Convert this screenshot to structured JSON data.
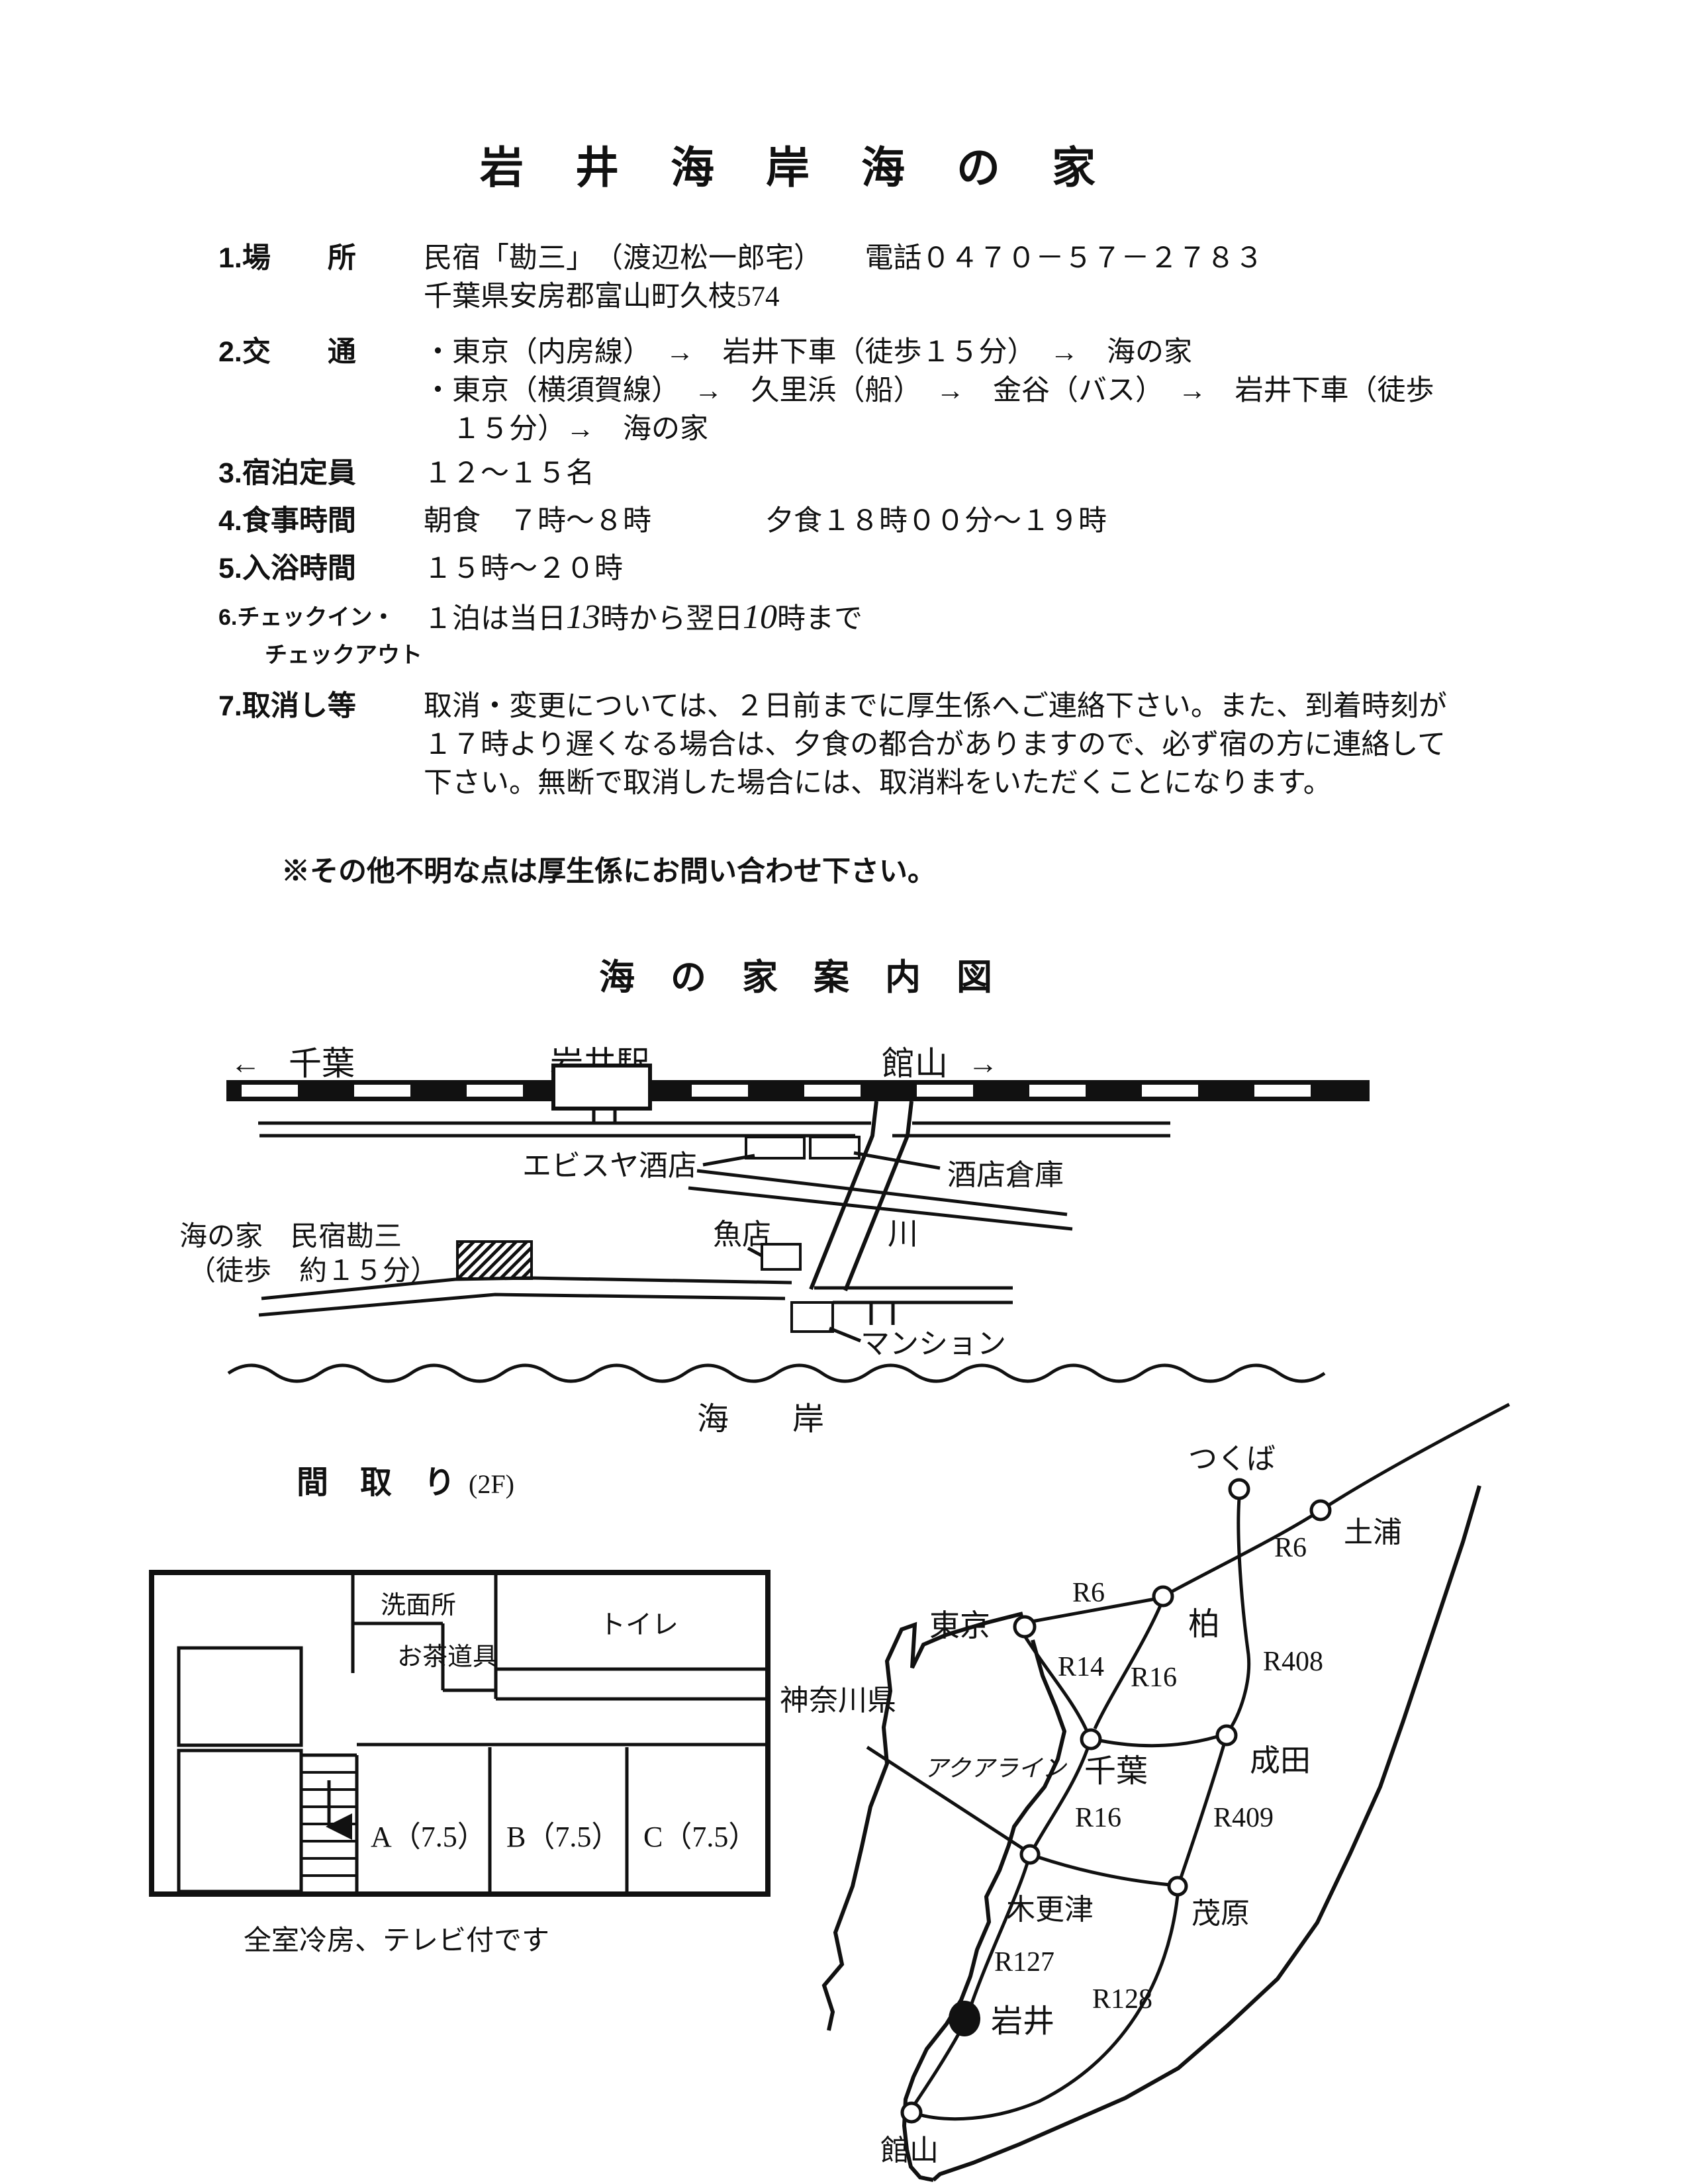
{
  "doc": {
    "title": "岩　井　海　岸　海　の　家",
    "note": "※その他不明な点は厚生係にお問い合わせ下さい。"
  },
  "info": {
    "items": [
      {
        "label": "1.場　　所",
        "lines": [
          "民宿「勘三」　（渡辺松一郎宅）　　電話０４７０－５７－２７８３",
          "千葉県安房郡富山町久枝574"
        ]
      },
      {
        "label": "2.交　　通",
        "lines": [
          "・東京（内房線）　→　岩井下車（徒歩１５分）　→　海の家",
          "・東京（横須賀線）　→　久里浜（船）　→　金谷（バス）　→　岩井下車（徒歩",
          "　１５分）→　海の家"
        ]
      },
      {
        "label": "3.宿泊定員",
        "lines": [
          "１２～１５名"
        ]
      },
      {
        "label": "4.食事時間",
        "lines": [
          "朝食　７時～８時　　　　夕食１８時００分～１９時"
        ]
      },
      {
        "label": "5.入浴時間",
        "lines": [
          "１５時～２０時"
        ]
      },
      {
        "label": "6.チェックイン・",
        "label2": "チェックアウト",
        "parts": [
          "１泊は当日",
          "13",
          "時から翌日",
          "10",
          "時まで"
        ]
      },
      {
        "label": "7.取消し等",
        "lines": [
          "取消・変更については、２日前までに厚生係へご連絡下さい。また、到着時刻が",
          "１７時より遅くなる場合は、夕食の都合がありますので、必ず宿の方に連絡して",
          "下さい。無断で取消した場合には、取消料をいただくことになります。"
        ]
      }
    ]
  },
  "guide_map": {
    "title": "海　の　家　案　内　図",
    "left_arrow": "←",
    "chiba": "千葉",
    "station": "岩井駅",
    "tateyama": "館山",
    "right_arrow": "→",
    "ebisuya": "エビスヤ酒店",
    "warehouse": "酒店倉庫",
    "river": "川",
    "fish_shop": "魚店",
    "minshuku1": "海の家　民宿勘三",
    "minshuku2": "（徒歩　約１５分）",
    "mansion": "マンション",
    "coast": "海　　岸"
  },
  "floor_plan": {
    "title": "間　取　り",
    "floor": "(2F)",
    "washroom": "洗面所",
    "tea": "お茶道具",
    "toilet": "トイレ",
    "room_a": "A（7.5）",
    "room_b": "B（7.5）",
    "room_c": "C（7.5）",
    "note": "全室冷房、テレビ付です"
  },
  "road_map": {
    "tsukuba": "つくば",
    "tsuchiura": "土浦",
    "tokyo": "東京",
    "kashiwa": "柏",
    "kanagawa": "神奈川県",
    "aqualine": "アクアライン",
    "chiba": "千葉",
    "narita": "成田",
    "kisarazu": "木更津",
    "mobara": "茂原",
    "iwai": "岩井",
    "tateyama": "館山",
    "r6_upper": "R6",
    "r6_tokyo": "R6",
    "r14": "R14",
    "r16_kashiwa": "R16",
    "r16_chiba": "R16",
    "r408": "R408",
    "r409": "R409",
    "r127": "R127",
    "r128": "R128"
  }
}
